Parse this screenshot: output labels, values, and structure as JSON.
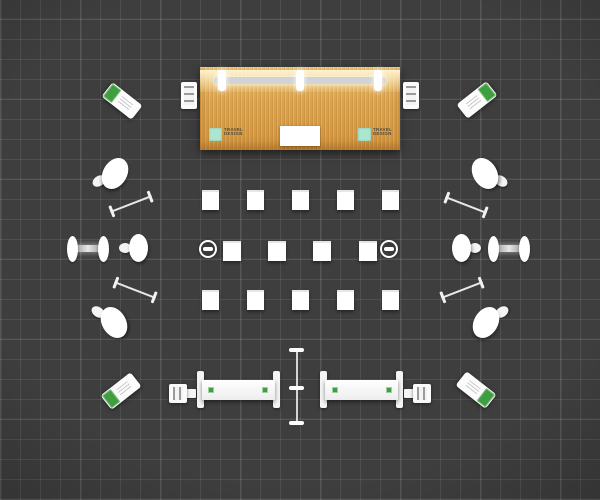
{
  "backwall": {
    "material": "wood-grain panel with lighting truss",
    "wood_colors": [
      "#f0c878",
      "#d89840"
    ],
    "truss": {
      "color": "#cfd3d6",
      "clamp_count": 3
    },
    "monitor_color": "#ffffff",
    "logo": {
      "line1": "TRAVEL",
      "line2": "DESIGN",
      "mark_color": "#ade6cf",
      "text_color": "#4a4a42"
    }
  },
  "floor": {
    "color": "#3e3e3e",
    "grid_line_color": "#545454",
    "grid_cell_px": 20
  },
  "furniture": {
    "cocktail_tables": 6,
    "display_pedestal_rows": [
      5,
      4,
      5
    ],
    "display_pedestals_total": 14,
    "spotlights": 2,
    "benches": 4,
    "barbell_benches": 2,
    "reception_counters": 2,
    "counter_logos_per_counter": 2,
    "literature_racks": 4,
    "corner_kiosks": 4,
    "banner_pole_ticks": 3
  },
  "palette": {
    "white": "#ffffff",
    "accent_green": "#3f9e3f",
    "accent_teal": "#ade6cf",
    "floor": "#3e3e3e"
  }
}
